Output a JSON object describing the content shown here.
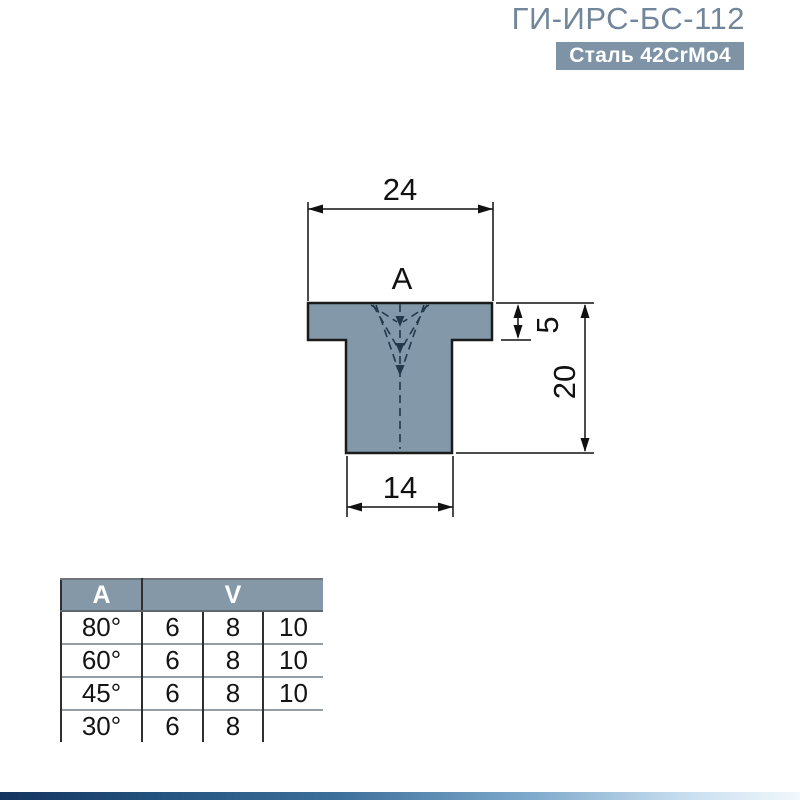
{
  "header": {
    "title": "ГИ-ИРС-БС-112",
    "material_badge": "Сталь 42CrMo4"
  },
  "drawing": {
    "section_label": "A",
    "dims": {
      "top_width": "24",
      "flange_height": "5",
      "total_height": "20",
      "stem_width": "14"
    }
  },
  "spec_table": {
    "headers": {
      "angle": "A",
      "v_opening": "V"
    },
    "rows": [
      {
        "angle": "80°",
        "v1": "6",
        "v2": "8",
        "v3": "10"
      },
      {
        "angle": "60°",
        "v1": "6",
        "v2": "8",
        "v3": "10"
      },
      {
        "angle": "45°",
        "v1": "6",
        "v2": "8",
        "v3": "10"
      },
      {
        "angle": "30°",
        "v1": "6",
        "v2": "8",
        "v3": ""
      }
    ]
  },
  "colors": {
    "title_text": "#71869A",
    "badge_bg": "#7E93A5",
    "table_header_bg": "#8598A8",
    "part_fill": "#8399AA",
    "drawing_line": "#1B1B1B",
    "dashed_line": "#24384C",
    "row_divider": "#959DA4"
  }
}
